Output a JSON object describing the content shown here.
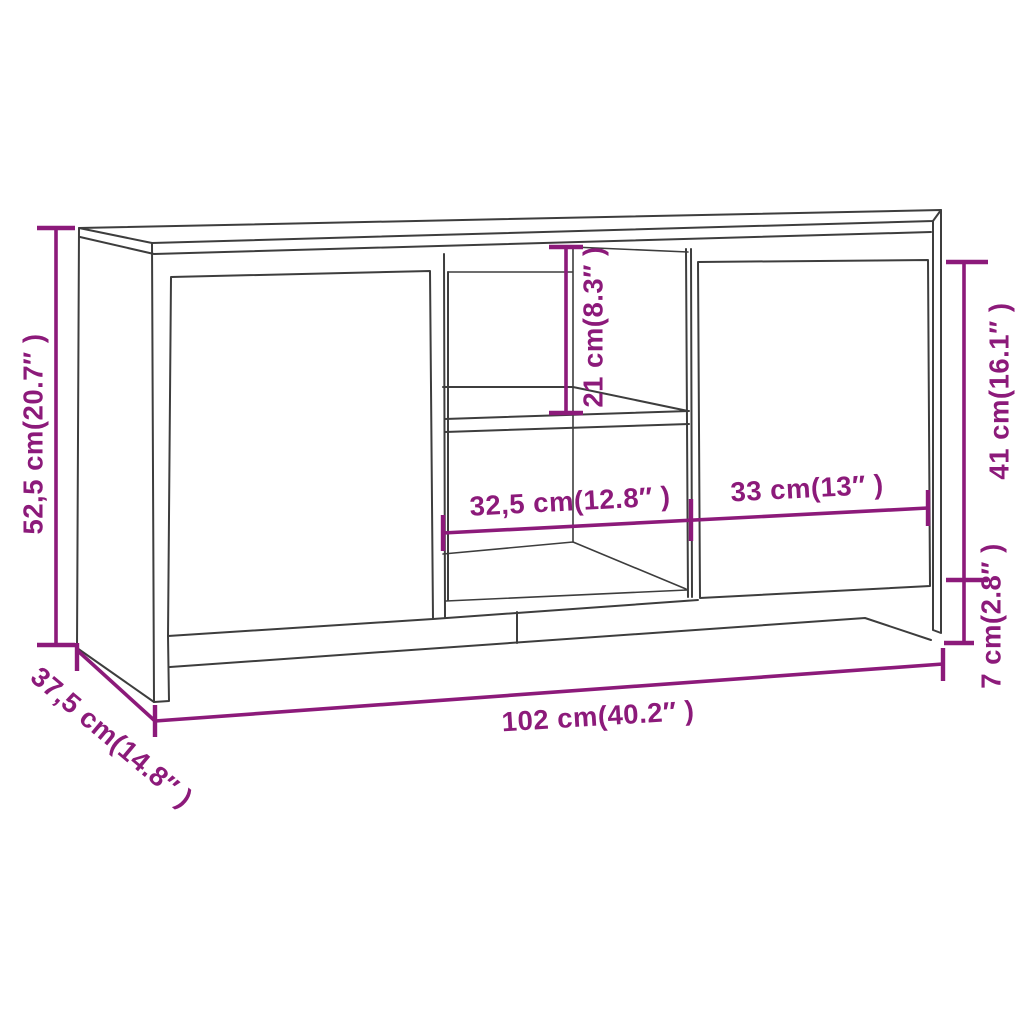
{
  "figure": {
    "kind": "furniture-dimension-diagram",
    "background_color": "#ffffff",
    "drawing_line_color": "#3d3d3d",
    "dimension_color": "#8c1a7a"
  },
  "dimensions": {
    "overall_height": {
      "label": "52,5 cm(20.7″ )",
      "cm": "52,5",
      "inches": "20.7"
    },
    "overall_depth": {
      "label": "37,5 cm(14.8″ )",
      "cm": "37,5",
      "inches": "14.8"
    },
    "overall_width": {
      "label": "102 cm(40.2″ )",
      "cm": "102",
      "inches": "40.2"
    },
    "left_opening_width": {
      "label": "32,5 cm(12.8″ )",
      "cm": "32,5",
      "inches": "12.8"
    },
    "right_door_width": {
      "label": "33 cm(13″ )",
      "cm": "33",
      "inches": "13"
    },
    "upper_opening_height": {
      "label": "21 cm(8.3″ )",
      "cm": "21",
      "inches": "8.3"
    },
    "door_height": {
      "label": "41 cm(16.1″ )",
      "cm": "41",
      "inches": "16.1"
    },
    "leg_height": {
      "label": "7 cm(2.8″ )",
      "cm": "7",
      "inches": "2.8"
    }
  }
}
